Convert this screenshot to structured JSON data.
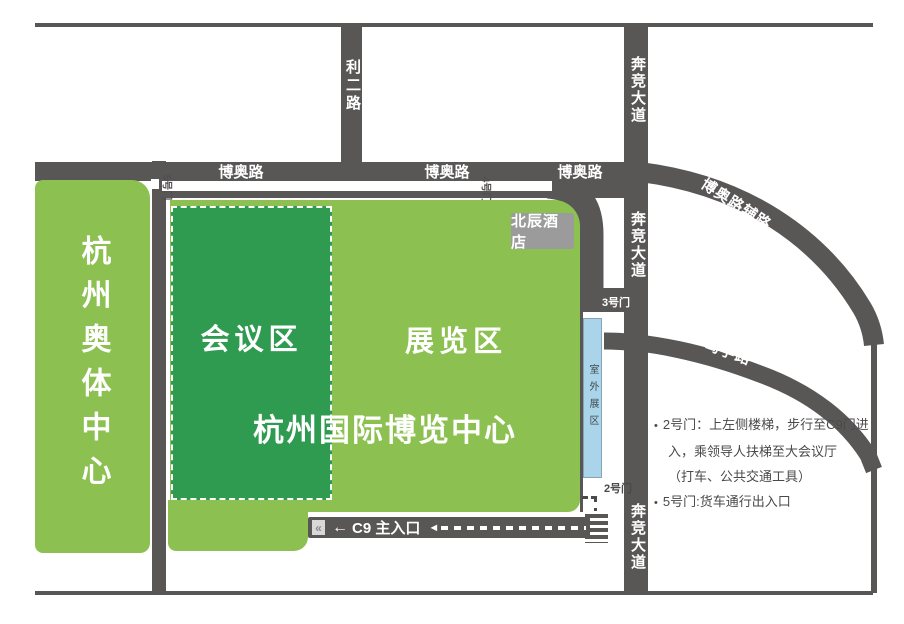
{
  "colors": {
    "road": "#595656",
    "green_light": "#8cc152",
    "green_dark": "#2f9b51",
    "outdoor_blue": "#a9d4e9",
    "hotel_gray": "#9b9b9b",
    "note_text": "#4a4a4a"
  },
  "site": {
    "olympic_center": "杭州奥体中心",
    "expo_center": "杭州国际博览中心",
    "conference_zone": "会议区",
    "exhibition_zone": "展览区",
    "hotel": "北辰酒店",
    "outdoor_zone": "室外展区"
  },
  "roads": {
    "boao": "博奥路",
    "lier": "利二路",
    "benjing": "奔竞大道",
    "boao_fulu": "博奥路辅路",
    "duxue": "笃学路"
  },
  "gates": {
    "gate2": "2号门",
    "gate3": "3号门",
    "gate4": "4号门",
    "gate5": "5号门"
  },
  "entrance": {
    "label": "C9 主入口",
    "arrow_left": "←",
    "arrowhead_left": "◄",
    "gate_glyph": "«"
  },
  "notes": {
    "bullet": "•",
    "line1": "2号门：上左侧楼梯，步行至C9门进",
    "line2": "入，乘领导人扶梯至大会议厅",
    "line3": "（打车、公共交通工具）",
    "line4": "5号门:货车通行出入口"
  }
}
